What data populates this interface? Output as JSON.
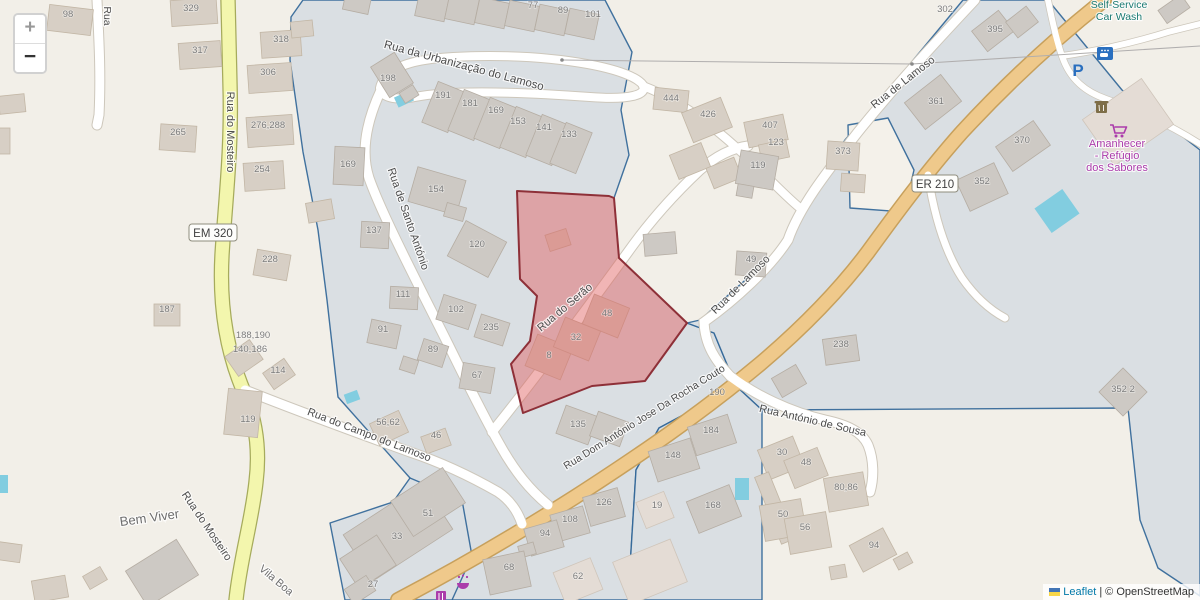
{
  "colors": {
    "background": "#f2efe8",
    "parcel_fill": "#dadfe3",
    "parcel_stroke": "#2e6496",
    "parcel_fill_light": "#f4f1ea",
    "selection_fill": "#e05c5c",
    "selection_stroke": "#8e3038",
    "road_primary": "#efc98b",
    "road_primary_casing": "#c7a05c",
    "road_secondary": "#f3f6ad",
    "road_secondary_casing": "#a6ab5c",
    "road_minor": "#ffffff",
    "road_minor_casing": "#cdc7bb",
    "water": "#82cde0",
    "building_fill": "#d7cfc5",
    "building_stroke": "#c2b6a5",
    "building_fill_gray": "#cdc9c4",
    "building_stroke_gray": "#b5ada3",
    "building_fill_pale": "#e4dcd5",
    "building_stroke_pale": "#cfc5ba",
    "label_street": "#4c4c4c",
    "label_housenumber": "#7c7c7c",
    "poi_teal": "#1a7a72",
    "poi_purple": "#ab3cab",
    "poi_blue": "#2a6fbf",
    "poi_brown": "#7e6e48",
    "leaflet_link": "#0078A8",
    "attribution_text": "#333333",
    "ref_text": "#3f3f3f"
  },
  "controls": {
    "zoom_in_label": "+",
    "zoom_out_label": "−"
  },
  "attribution": {
    "leaflet_label": "Leaflet",
    "separator": "|",
    "copyright_label": "© OpenStreetMap"
  },
  "poi": {
    "parking_glyph": "P"
  },
  "road_refs": [
    {
      "label": "EM 320",
      "x": 213,
      "y": 233,
      "w": 48
    },
    {
      "label": "ER 210",
      "x": 935,
      "y": 184,
      "w": 46
    }
  ],
  "street_labels": [
    {
      "t": "Rua da Urbanização do Lamoso",
      "x": 463,
      "y": 69,
      "r": 15,
      "s": 11.5
    },
    {
      "t": "Rua do Mosteiro",
      "x": 227,
      "y": 132,
      "r": 90,
      "s": 11
    },
    {
      "t": "Rua",
      "x": 104,
      "y": 16,
      "r": 90,
      "s": 10.5
    },
    {
      "t": "Rua de Santo António",
      "x": 405,
      "y": 220,
      "r": 71,
      "s": 11
    },
    {
      "t": "Rua do Serão",
      "x": 567,
      "y": 310,
      "r": -40,
      "s": 11
    },
    {
      "t": "Rua Dom António Jose Da Rocha Couto",
      "x": 646,
      "y": 420,
      "r": -32,
      "s": 10.5
    },
    {
      "t": "Rua de Lamoso",
      "x": 905,
      "y": 85,
      "r": -38,
      "s": 11
    },
    {
      "t": "Rua de Lamoso",
      "x": 743,
      "y": 287,
      "r": -45,
      "s": 11
    },
    {
      "t": "Rua António de Sousa",
      "x": 812,
      "y": 424,
      "r": 13,
      "s": 11
    },
    {
      "t": "Rua do Campo do Lamoso",
      "x": 368,
      "y": 438,
      "r": 21,
      "s": 11
    },
    {
      "t": "Rua do Mosteiro",
      "x": 204,
      "y": 528,
      "r": 56,
      "s": 11
    }
  ],
  "place_labels": [
    {
      "t": "Bem Viver",
      "x": 150,
      "y": 522,
      "r": -8,
      "s": 13
    },
    {
      "t": "Vila Boa",
      "x": 274,
      "y": 583,
      "r": 40,
      "s": 11
    }
  ],
  "poi_labels": [
    {
      "t": "Self-Service",
      "x": 1119,
      "y": 8,
      "c": "teal",
      "s": 10.5
    },
    {
      "t": "Car Wash",
      "x": 1119,
      "y": 20,
      "c": "teal",
      "s": 10.5
    },
    {
      "t": "Amanhecer",
      "x": 1117,
      "y": 147,
      "c": "purple",
      "s": 11
    },
    {
      "t": "- Refúgio",
      "x": 1117,
      "y": 159,
      "c": "purple",
      "s": 11
    },
    {
      "t": "dos Sabores",
      "x": 1117,
      "y": 171,
      "c": "purple",
      "s": 11
    }
  ],
  "house_numbers": [
    {
      "t": "98",
      "x": 68,
      "y": 17
    },
    {
      "t": "329",
      "x": 191,
      "y": 11
    },
    {
      "t": "317",
      "x": 200,
      "y": 53
    },
    {
      "t": "318",
      "x": 281,
      "y": 42
    },
    {
      "t": "306",
      "x": 268,
      "y": 75
    },
    {
      "t": "276,288",
      "x": 268,
      "y": 128
    },
    {
      "t": "265",
      "x": 178,
      "y": 135
    },
    {
      "t": "254",
      "x": 262,
      "y": 172
    },
    {
      "t": "228",
      "x": 270,
      "y": 262
    },
    {
      "t": "187",
      "x": 167,
      "y": 312
    },
    {
      "t": "169",
      "x": 348,
      "y": 167
    },
    {
      "t": "188,190",
      "x": 253,
      "y": 338
    },
    {
      "t": "140,186",
      "x": 250,
      "y": 352
    },
    {
      "t": "114",
      "x": 278,
      "y": 373
    },
    {
      "t": "119",
      "x": 248,
      "y": 422
    },
    {
      "t": "56,62",
      "x": 388,
      "y": 425
    },
    {
      "t": "46",
      "x": 436,
      "y": 438
    },
    {
      "t": "77",
      "x": 533,
      "y": 8
    },
    {
      "t": "89",
      "x": 563,
      "y": 13
    },
    {
      "t": "101",
      "x": 593,
      "y": 17
    },
    {
      "t": "198",
      "x": 388,
      "y": 81
    },
    {
      "t": "191",
      "x": 443,
      "y": 98
    },
    {
      "t": "181",
      "x": 470,
      "y": 106
    },
    {
      "t": "169",
      "x": 496,
      "y": 113
    },
    {
      "t": "153",
      "x": 518,
      "y": 124
    },
    {
      "t": "141",
      "x": 544,
      "y": 130
    },
    {
      "t": "133",
      "x": 569,
      "y": 137
    },
    {
      "t": "154",
      "x": 436,
      "y": 192
    },
    {
      "t": "137",
      "x": 374,
      "y": 233
    },
    {
      "t": "120",
      "x": 477,
      "y": 247
    },
    {
      "t": "111",
      "x": 403,
      "y": 297
    },
    {
      "t": "102",
      "x": 456,
      "y": 312
    },
    {
      "t": "91",
      "x": 383,
      "y": 332
    },
    {
      "t": "235",
      "x": 491,
      "y": 330
    },
    {
      "t": "89",
      "x": 433,
      "y": 352
    },
    {
      "t": "67",
      "x": 477,
      "y": 378
    },
    {
      "t": "135",
      "x": 578,
      "y": 427
    },
    {
      "t": "8",
      "x": 549,
      "y": 358
    },
    {
      "t": "32",
      "x": 576,
      "y": 340
    },
    {
      "t": "48",
      "x": 607,
      "y": 316
    },
    {
      "t": "444",
      "x": 671,
      "y": 101
    },
    {
      "t": "426",
      "x": 708,
      "y": 117
    },
    {
      "t": "407",
      "x": 770,
      "y": 128
    },
    {
      "t": "123",
      "x": 776,
      "y": 145
    },
    {
      "t": "119",
      "x": 758,
      "y": 168
    },
    {
      "t": "373",
      "x": 843,
      "y": 154
    },
    {
      "t": "49",
      "x": 751,
      "y": 262
    },
    {
      "t": "302",
      "x": 945,
      "y": 12
    },
    {
      "t": "395",
      "x": 995,
      "y": 32
    },
    {
      "t": "361",
      "x": 936,
      "y": 104
    },
    {
      "t": "370",
      "x": 1022,
      "y": 143
    },
    {
      "t": "352",
      "x": 982,
      "y": 184
    },
    {
      "t": "352 2",
      "x": 1123,
      "y": 392
    },
    {
      "t": "238",
      "x": 841,
      "y": 347
    },
    {
      "t": "190",
      "x": 717,
      "y": 395
    },
    {
      "t": "184",
      "x": 711,
      "y": 433
    },
    {
      "t": "148",
      "x": 673,
      "y": 458
    },
    {
      "t": "168",
      "x": 713,
      "y": 508
    },
    {
      "t": "19",
      "x": 657,
      "y": 508
    },
    {
      "t": "126",
      "x": 604,
      "y": 505
    },
    {
      "t": "108",
      "x": 570,
      "y": 522
    },
    {
      "t": "94",
      "x": 545,
      "y": 536
    },
    {
      "t": "68",
      "x": 509,
      "y": 570
    },
    {
      "t": "62",
      "x": 578,
      "y": 579
    },
    {
      "t": "30",
      "x": 782,
      "y": 455
    },
    {
      "t": "48",
      "x": 806,
      "y": 465
    },
    {
      "t": "80,86",
      "x": 846,
      "y": 490
    },
    {
      "t": "50",
      "x": 783,
      "y": 517
    },
    {
      "t": "56",
      "x": 805,
      "y": 530
    },
    {
      "t": "94",
      "x": 874,
      "y": 548
    },
    {
      "t": "51",
      "x": 428,
      "y": 516
    },
    {
      "t": "33",
      "x": 397,
      "y": 539
    },
    {
      "t": "27",
      "x": 373,
      "y": 587
    }
  ]
}
